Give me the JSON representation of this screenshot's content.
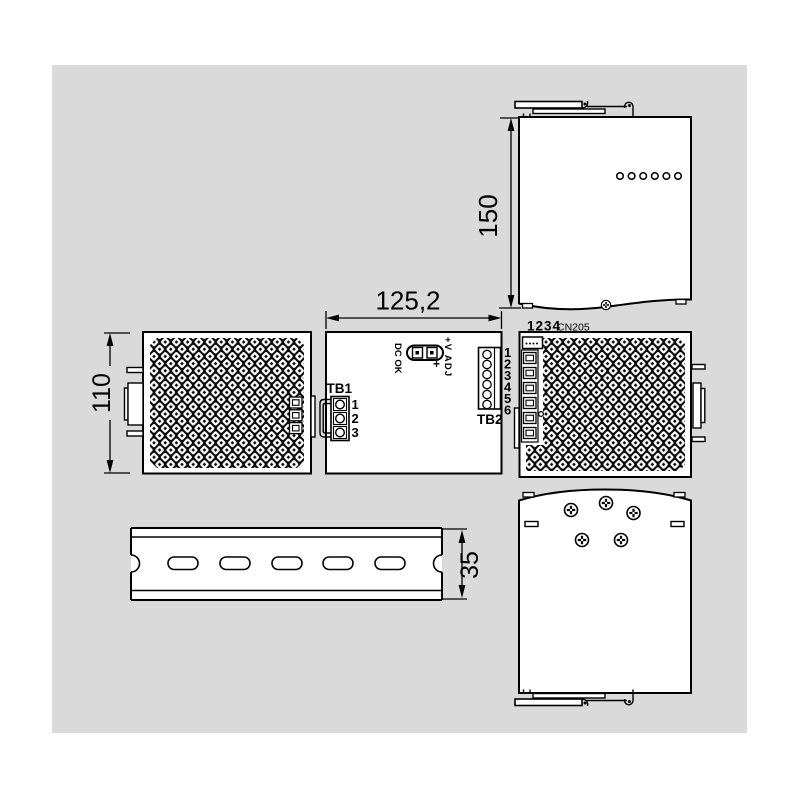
{
  "colors": {
    "background": "#dadada",
    "line": "#000000",
    "fill": "#ffffff"
  },
  "dimensions": {
    "side_height": "150",
    "front_width": "125,2",
    "left_height": "110",
    "rail_height": "35"
  },
  "front_view": {
    "dc_ok": "DC OK",
    "v_adj": "+V ADJ",
    "plus": "+",
    "tb1": {
      "label": "TB1",
      "terminals": [
        "1",
        "2",
        "3"
      ]
    },
    "tb2": {
      "label": "TB2",
      "terminals": [
        "1",
        "2",
        "3",
        "4",
        "5",
        "6"
      ]
    }
  },
  "right_side_view": {
    "pin_numbers": "1234",
    "connector": "CN205"
  }
}
